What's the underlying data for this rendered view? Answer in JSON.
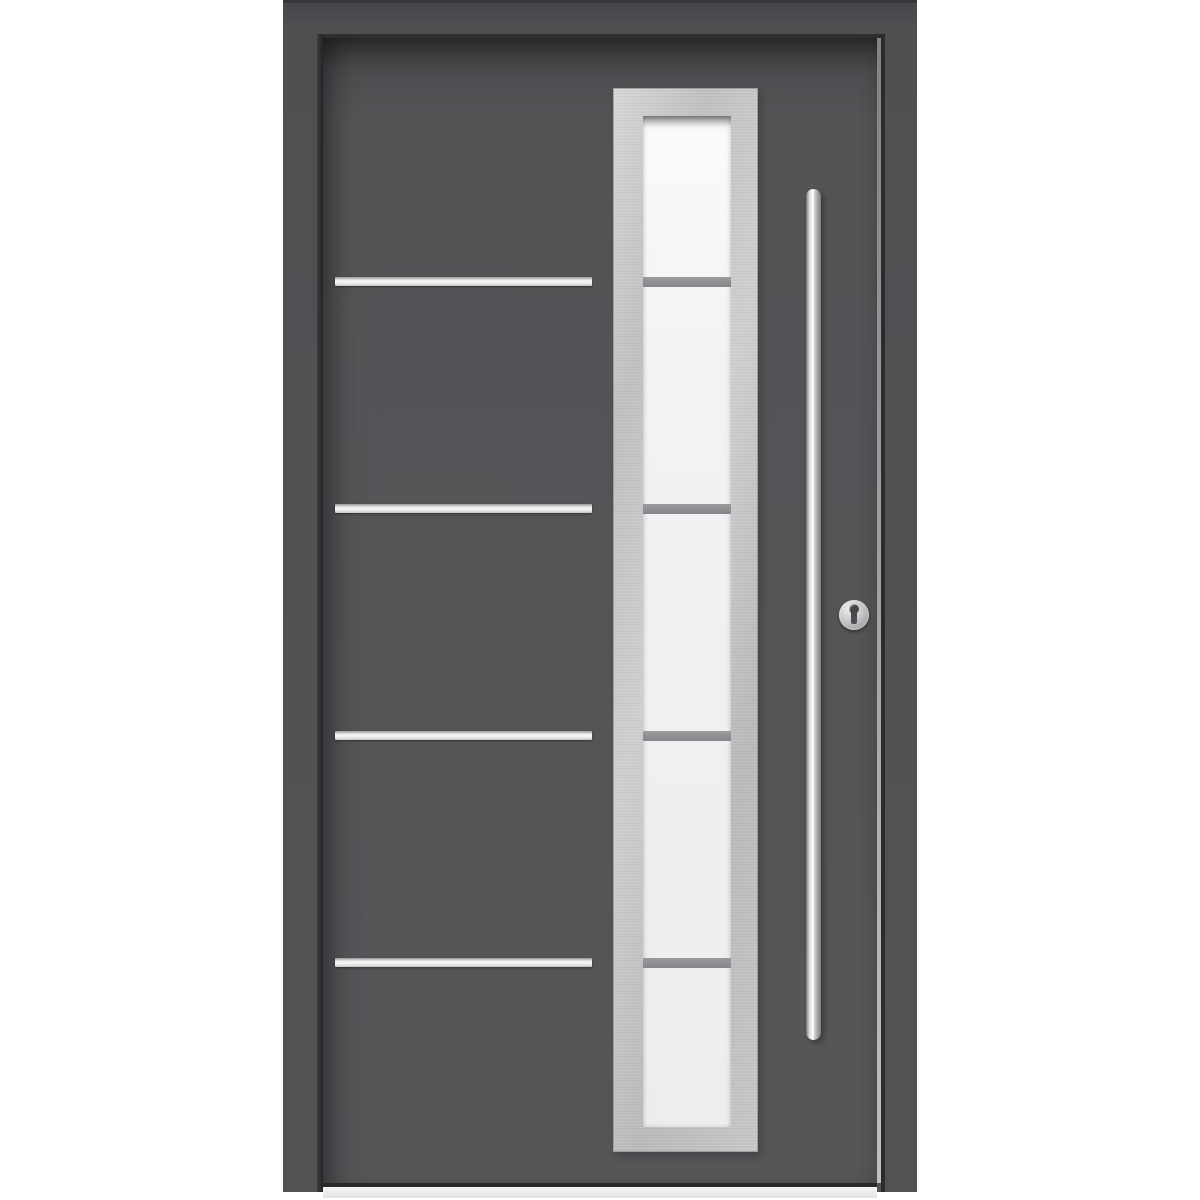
{
  "image": {
    "type": "product-photo",
    "subject": "Modern anthracite aluminium entry door, front view",
    "background_color": "#ffffff"
  },
  "door": {
    "frame": {
      "color": "#4f4f52",
      "top_edge_color": "#38383b"
    },
    "leaf": {
      "color": "#545457",
      "shadow_gap_color": "#2e2e31"
    },
    "inlay_stripes": {
      "count": 4,
      "material": "stainless-steel",
      "color": "#ededee",
      "x_px": 335,
      "width_px": 257,
      "height_px": 9,
      "y_px": [
        277,
        504,
        731,
        958
      ]
    },
    "glazing": {
      "pane_count": 5,
      "frame_material": "stainless-steel",
      "frame_color": "#c9c9cb",
      "glass_color": "#f0f0f2",
      "divider_color": "#8d8d8f",
      "divider_height_px": 10,
      "glass_top_px": 116,
      "divider_y_px": [
        277,
        504,
        731,
        958
      ]
    },
    "hardware": {
      "handle": {
        "type": "vertical-bar-pull",
        "material": "stainless-steel",
        "color": "#d9d9db"
      },
      "lock": {
        "type": "euro-cylinder-escutcheon",
        "color": "#c2c2c4",
        "keyhole_color": "#454548"
      }
    },
    "threshold": {
      "color": "#e8e8ea"
    }
  }
}
